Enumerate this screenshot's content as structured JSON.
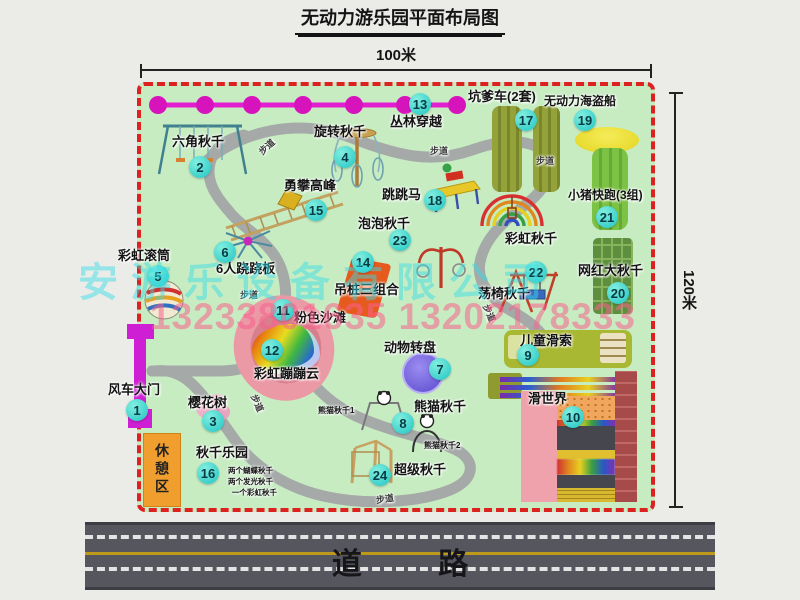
{
  "title": "无动力游乐园平面布局图",
  "dimensions": {
    "width_label": "100米",
    "height_label": "120米"
  },
  "road": {
    "label": "道 路"
  },
  "watermark": {
    "company": "安游乐设备有限公司",
    "phone": "13233801635 13202178333"
  },
  "path_label": "步道",
  "extra_labels": {
    "rest_area": "休憩区",
    "rainbow_swing": "彩虹秋千",
    "panda_swing_1": "熊猫秋千1",
    "panda_swing_2": "熊猫秋千2"
  },
  "swing_park_notes": [
    "两个蝴蝶秋千",
    "两个发光秋千",
    "一个彩虹秋千"
  ],
  "attractions": [
    {
      "num": "1",
      "name": "风车大门"
    },
    {
      "num": "2",
      "name": "六角秋千"
    },
    {
      "num": "3",
      "name": "樱花树"
    },
    {
      "num": "4",
      "name": "旋转秋千"
    },
    {
      "num": "5",
      "name": "彩虹滚筒"
    },
    {
      "num": "6",
      "name": "6人跷跷板"
    },
    {
      "num": "7",
      "name": "动物转盘"
    },
    {
      "num": "8",
      "name": "熊猫秋千"
    },
    {
      "num": "9",
      "name": "儿童滑索"
    },
    {
      "num": "10",
      "name": "滑世界"
    },
    {
      "num": "11",
      "name": "粉色沙滩"
    },
    {
      "num": "12",
      "name": "彩虹蹦蹦云"
    },
    {
      "num": "13",
      "name": "丛林穿越"
    },
    {
      "num": "14",
      "name": "吊桩三组合"
    },
    {
      "num": "15",
      "name": "勇攀高峰"
    },
    {
      "num": "16",
      "name": "秋千乐园"
    },
    {
      "num": "17",
      "name": "坑爹车(2套)"
    },
    {
      "num": "18",
      "name": "跳跳马"
    },
    {
      "num": "19",
      "name": "无动力海盗船"
    },
    {
      "num": "20",
      "name": "网红大秋千"
    },
    {
      "num": "21",
      "name": "小猪快跑(3组)"
    },
    {
      "num": "22",
      "name": "荡椅秋千"
    },
    {
      "num": "23",
      "name": "泡泡秋千"
    },
    {
      "num": "24",
      "name": "超级秋千"
    }
  ],
  "colors": {
    "park_green": "#c7ecc2",
    "border_red": "#dd2020",
    "marker_cyan": "#20c4c4",
    "chain_magenta": "#e11fd0",
    "gate_magenta": "#cf1fd4",
    "rest_orange": "#f09f2e",
    "road_gray": "#56565e"
  }
}
